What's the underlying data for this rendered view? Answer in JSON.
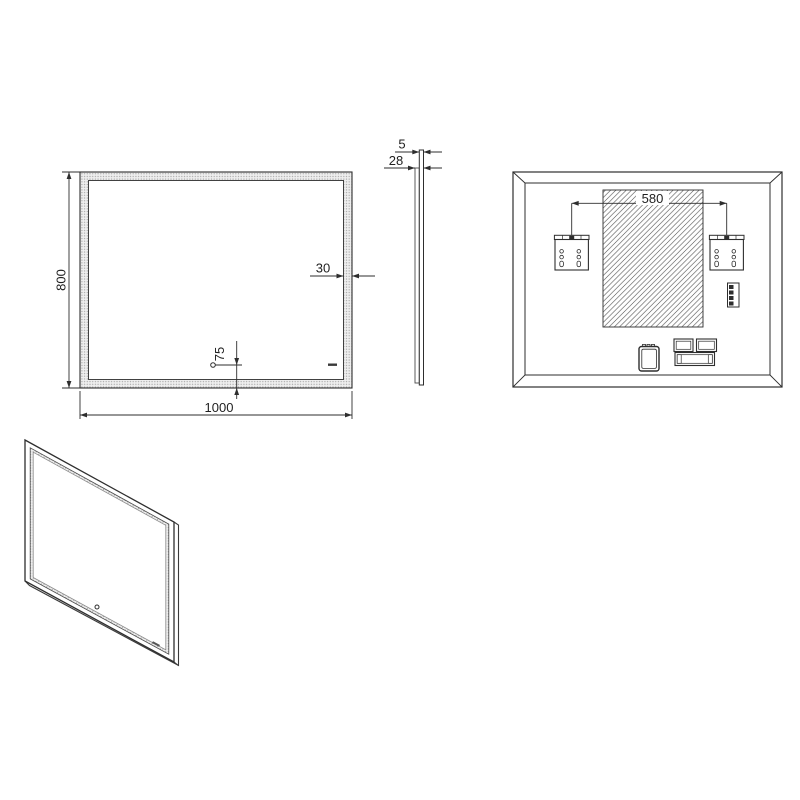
{
  "drawing": {
    "colors": {
      "background": "#ffffff",
      "line": "#2e2e2e",
      "stipple_dot": "#a8a8a8",
      "stipple_base": "#efefef",
      "hatch_line": "#3a3a3a",
      "text": "#1f1f1f"
    },
    "views": {
      "front": {
        "height_mm": "800",
        "width_mm": "1000",
        "frame_width_mm": "30",
        "sensor_offset_mm": "75"
      },
      "side": {
        "glass_thickness_mm": "5",
        "depth_mm": "28"
      },
      "back": {
        "bracket_spacing_mm": "580"
      }
    }
  }
}
